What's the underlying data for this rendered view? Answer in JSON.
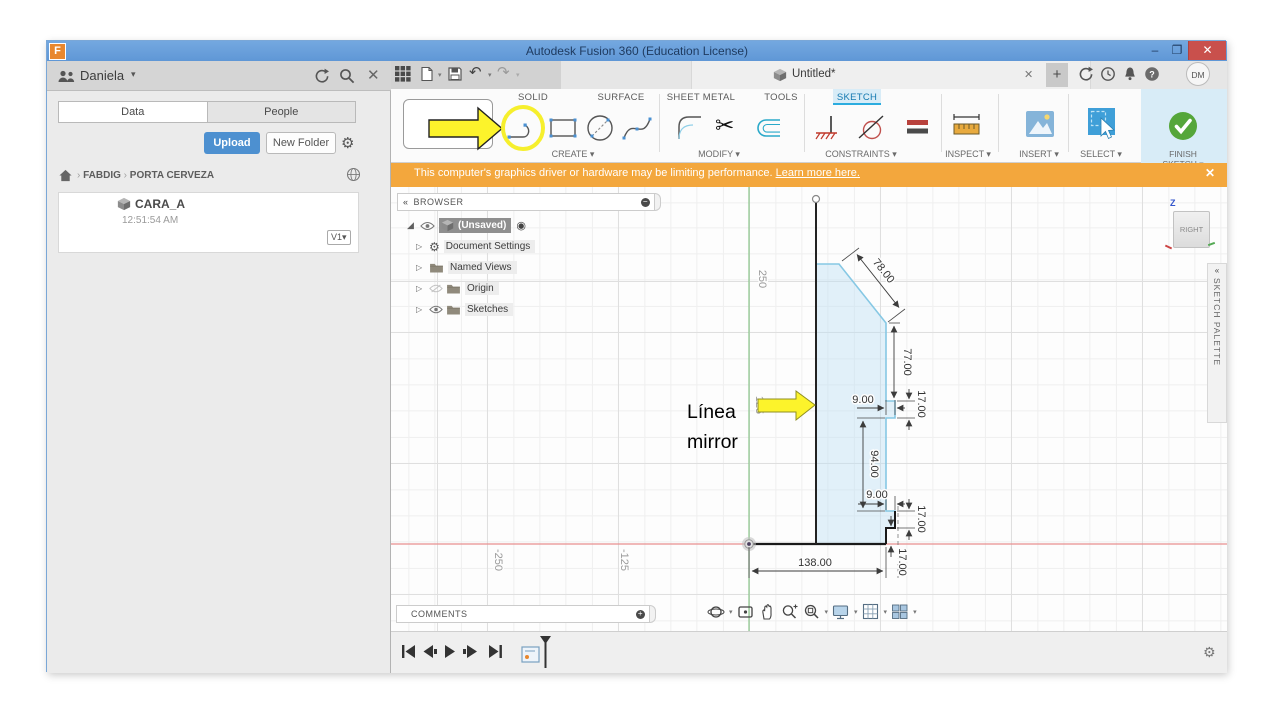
{
  "titlebar": {
    "title": "Autodesk Fusion 360 (Education License)",
    "logo": "F"
  },
  "doc_tab": {
    "label": "Untitled*"
  },
  "account": {
    "avatar": "DM"
  },
  "ribbon": {
    "tabs": [
      "SOLID",
      "SURFACE",
      "SHEET METAL",
      "TOOLS",
      "SKETCH"
    ],
    "active_tab": "SKETCH",
    "groups": [
      {
        "label": "CREATE ▾"
      },
      {
        "label": "MODIFY ▾"
      },
      {
        "label": "CONSTRAINTS ▾"
      },
      {
        "label": "INSPECT ▾"
      },
      {
        "label": "INSERT ▾"
      },
      {
        "label": "SELECT ▾"
      },
      {
        "label": "FINISH SKETCH ▾"
      }
    ]
  },
  "warning": {
    "message": "This computer's graphics driver or hardware may be limiting performance.",
    "link": "Learn more here."
  },
  "data_panel": {
    "user": "Daniela",
    "tabs": [
      {
        "label": "Data"
      },
      {
        "label": "People"
      }
    ],
    "upload": "Upload",
    "new_folder": "New Folder",
    "breadcrumb": [
      "FABDIG",
      "PORTA CERVEZA"
    ],
    "item": {
      "name": "CARA_A",
      "time": "12:51:54 AM",
      "version": "V1▾"
    }
  },
  "browser": {
    "title": "BROWSER",
    "root": "(Unsaved)",
    "nodes": [
      {
        "label": "Document Settings"
      },
      {
        "label": "Named Views"
      },
      {
        "label": "Origin"
      },
      {
        "label": "Sketches"
      }
    ]
  },
  "comments": {
    "title": "COMMENTS"
  },
  "sketch_palette": {
    "title": "SKETCH PALETTE"
  },
  "viewcube": {
    "face": "RIGHT",
    "axis_z": "Z"
  },
  "canvas": {
    "axis_labels": {
      "y250": "250",
      "y125": "125",
      "xm250": "-250",
      "xm125": "-125"
    },
    "dims": {
      "d78": "78.00",
      "d77": "77.00",
      "d9_top": "9.00",
      "d17_top": "17.00",
      "d94": "94.00",
      "d9_bottom": "9.00",
      "d17_bottom": "17.00",
      "d17_base": "17.00",
      "d138": "138.00"
    },
    "annotation": {
      "line1": "Línea",
      "line2": "mirror"
    }
  }
}
